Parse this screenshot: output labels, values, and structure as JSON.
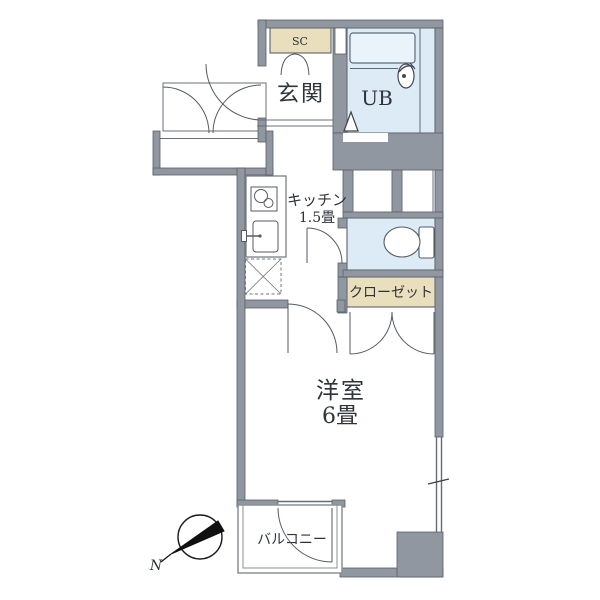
{
  "plan": {
    "type": "apartment-floor-plan",
    "compass_label": "N",
    "rooms": {
      "shoe_closet": {
        "label": "SC"
      },
      "entrance": {
        "label": "玄関"
      },
      "unit_bath": {
        "label": "UB"
      },
      "kitchen": {
        "label": "キッチン",
        "size": "1.5畳"
      },
      "closet": {
        "label": "クローゼット"
      },
      "western_room": {
        "label": "洋室",
        "size": "6畳"
      },
      "balcony": {
        "label": "バルコニー"
      }
    },
    "icons": {
      "bathtub": "bathtub-icon",
      "bath_faucet": "bath-faucet-icon",
      "bath_door": "folding-door-triangle-icon",
      "toilet": "toilet-icon",
      "stove": "two-burner-stove-icon",
      "sink": "kitchen-sink-icon",
      "refrigerator_space": "refrigerator-space-x-box-icon",
      "compass": "compass-needle-icon",
      "window": "window-tick-symbol"
    },
    "colors": {
      "wall": "#9097a0",
      "wet_area_fill": "#dcebf5",
      "storage_fill": "#e9dfbc",
      "bathtub_fill": "#eaf3fa",
      "line": "#555a63",
      "text": "#2e3338",
      "background": "#ffffff"
    }
  }
}
